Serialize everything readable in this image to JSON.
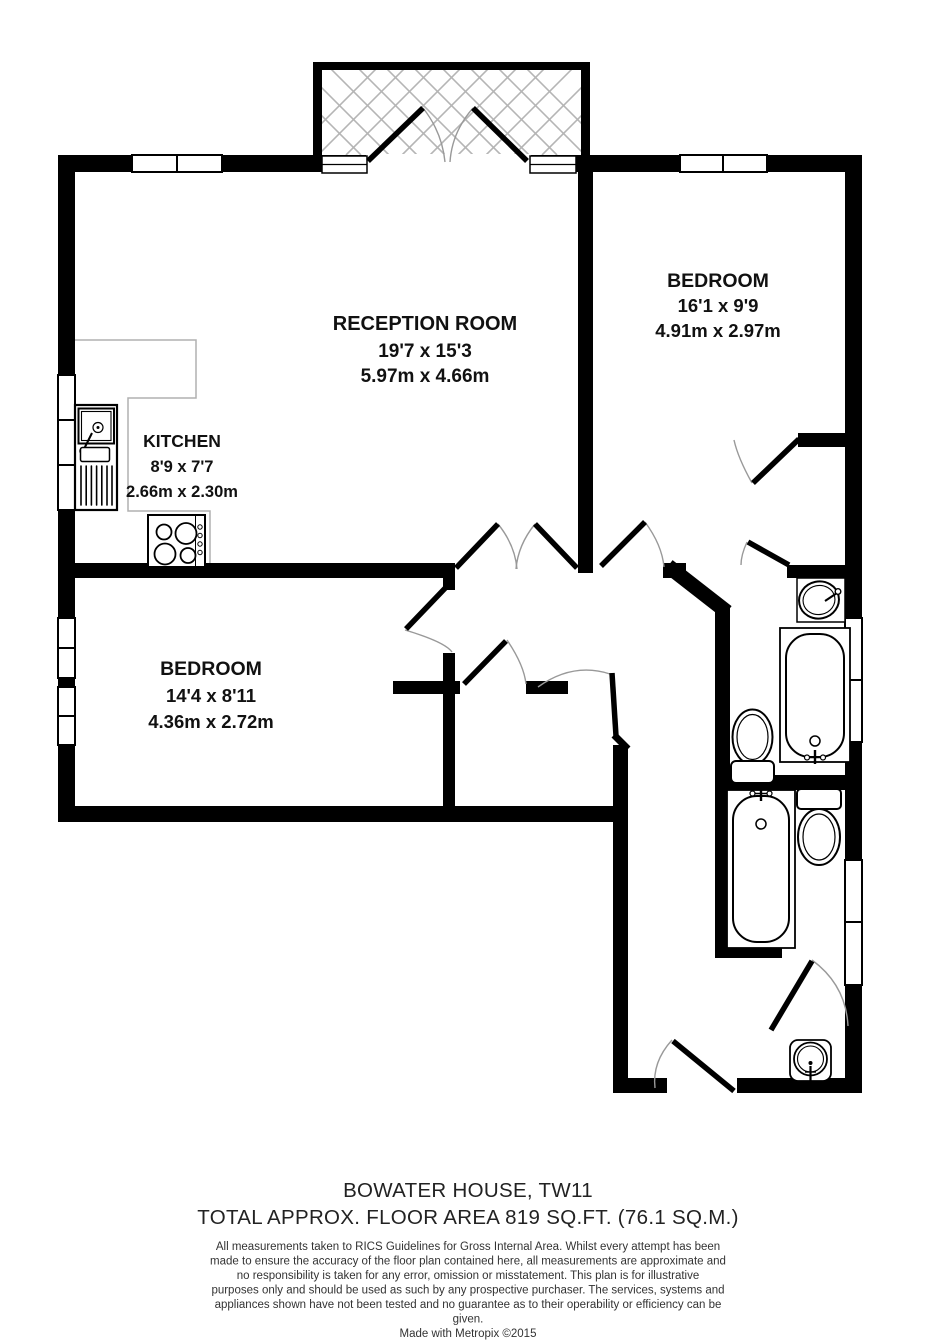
{
  "plan": {
    "rooms": {
      "reception": {
        "name": "RECEPTION ROOM",
        "imperial": "19'7 x 15'3",
        "metric": "5.97m x 4.66m"
      },
      "bedroom1": {
        "name": "BEDROOM",
        "imperial": "16'1 x 9'9",
        "metric": "4.91m x 2.97m"
      },
      "kitchen": {
        "name": "KITCHEN",
        "imperial": "8'9 x 7'7",
        "metric": "2.66m x 2.30m"
      },
      "bedroom2": {
        "name": "BEDROOM",
        "imperial": "14'4 x 8'11",
        "metric": "4.36m x 2.72m"
      }
    },
    "fixtures": [
      "balcony",
      "kitchen-sink",
      "hob",
      "counter",
      "bathtub",
      "toilet",
      "wash-basin",
      "bathtub",
      "toilet",
      "wash-basin"
    ],
    "colors": {
      "wall": "#000000",
      "door-arc": "#999999",
      "balcony-hatch": "#b5b5b5",
      "counter": "#b0b0b0",
      "background": "#ffffff"
    }
  },
  "footer": {
    "building": "BOWATER HOUSE, TW11",
    "area": "TOTAL APPROX. FLOOR AREA 819 SQ.FT. (76.1 SQ.M.)",
    "disclaimer": [
      "All measurements taken to RICS Guidelines for Gross Internal Area. Whilst every attempt has been",
      "made to ensure the accuracy of the floor plan contained here, all measurements are approximate and",
      "no responsibility is taken for any error, omission or misstatement. This plan is for illustrative",
      "purposes only and should be used as such by any prospective purchaser. The services, systems and",
      "appliances shown have not been tested and no guarantee as to their operability or efficiency can be",
      "given."
    ],
    "credit": "Made with Metropix ©2015"
  }
}
